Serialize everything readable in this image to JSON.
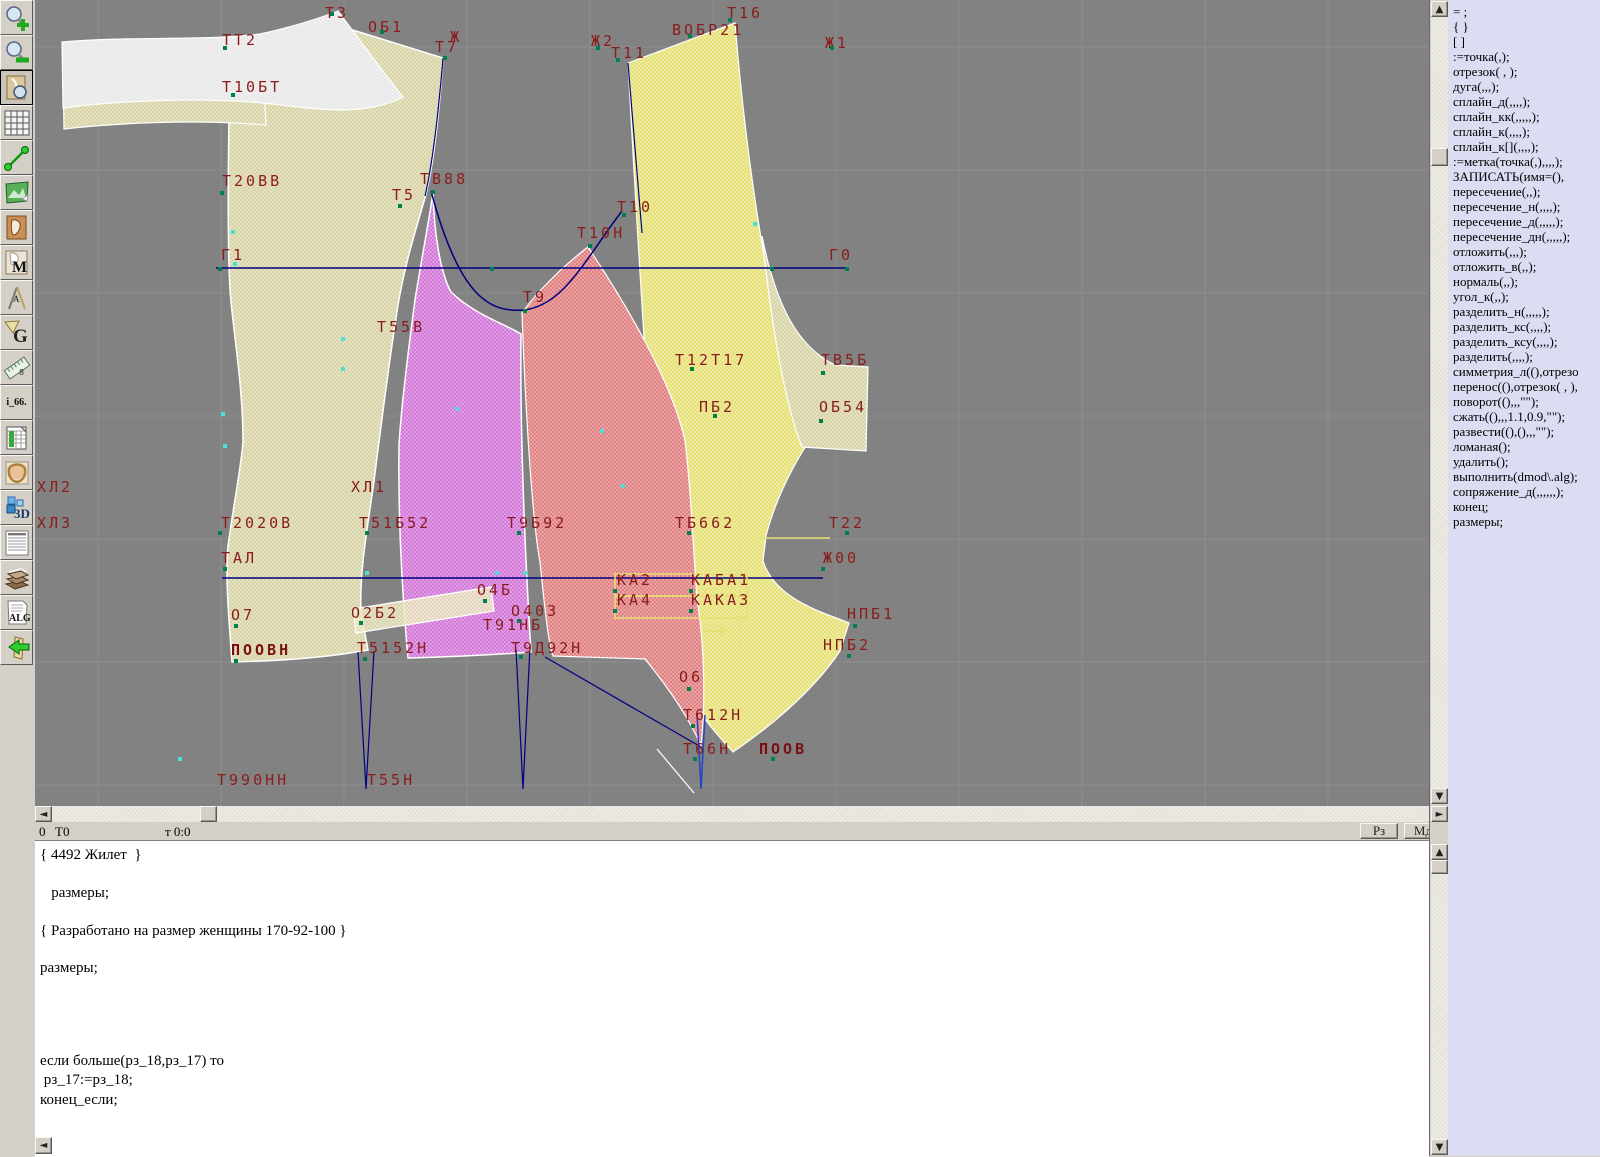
{
  "colors": {
    "canvas_bg": "#828282",
    "grid": "#8e8e8e",
    "beige": "#d6d2a2",
    "gray_piece": "#e7e7e7",
    "purple": "#d06ed6",
    "red": "#de7878",
    "yellow": "#e4e070",
    "navy": "#000080",
    "outline": "#ffffff",
    "label": "#8b1c1c",
    "panel_bg": "#dcdcf2",
    "chrome": "#d4d0c8"
  },
  "toolbar": {
    "icons": [
      {
        "name": "zoom-in-icon"
      },
      {
        "name": "zoom-out-icon"
      },
      {
        "name": "piece-zoom-icon",
        "active": true
      },
      {
        "name": "grid-icon"
      },
      {
        "name": "segment-icon"
      },
      {
        "name": "image-icon"
      },
      {
        "name": "pattern-card-icon"
      },
      {
        "name": "pattern-m-icon",
        "label": "M"
      },
      {
        "name": "measure-icon",
        "label": "А"
      },
      {
        "name": "g-icon",
        "label": "G"
      },
      {
        "name": "ruler-icon",
        "label": "8"
      },
      {
        "name": "i66-icon",
        "label": "i_66."
      },
      {
        "name": "table-icon"
      },
      {
        "name": "model-photo-icon"
      },
      {
        "name": "threed-icon",
        "label": "3D"
      },
      {
        "name": "list-icon"
      },
      {
        "name": "books-icon"
      },
      {
        "name": "alg-icon",
        "label": "ALG"
      },
      {
        "name": "exit-icon"
      }
    ]
  },
  "canvas": {
    "labels": [
      [
        "Т3",
        290,
        6
      ],
      [
        "ОБ1",
        333,
        20
      ],
      [
        "ТТ2",
        187,
        33
      ],
      [
        "Ж",
        415,
        30
      ],
      [
        "Т7",
        400,
        40
      ],
      [
        "Ж2",
        556,
        34
      ],
      [
        "Т11",
        576,
        46
      ],
      [
        "ВОБР21",
        637,
        23
      ],
      [
        "Т16",
        692,
        6
      ],
      [
        "Ж1",
        790,
        36
      ],
      [
        "Т10БТ",
        187,
        80
      ],
      [
        "Т20ВВ",
        187,
        174
      ],
      [
        "Т5",
        357,
        188
      ],
      [
        "ТВ88",
        385,
        172
      ],
      [
        "Т10",
        582,
        200
      ],
      [
        "Т10Н",
        542,
        226
      ],
      [
        "Г1",
        186,
        248
      ],
      [
        "Г0",
        794,
        248
      ],
      [
        "Т9",
        488,
        290
      ],
      [
        "Т55В",
        342,
        320
      ],
      [
        "Т12Т17",
        640,
        353
      ],
      [
        "ТВ5Б",
        786,
        353
      ],
      [
        "ПБ2",
        664,
        400
      ],
      [
        "ОБ54",
        784,
        400
      ],
      [
        "ХЛ2",
        2,
        480
      ],
      [
        "ХЛ1",
        316,
        480
      ],
      [
        "ХЛ3",
        2,
        516
      ],
      [
        "Т2020В",
        186,
        516
      ],
      [
        "Т51Б52",
        324,
        516
      ],
      [
        "Т9Б92",
        472,
        516
      ],
      [
        "ТБ662",
        640,
        516
      ],
      [
        "Т22",
        794,
        516
      ],
      [
        "ТАЛ",
        186,
        551
      ],
      [
        "Ж00",
        788,
        551
      ],
      [
        "КА2",
        582,
        573
      ],
      [
        "КАБА1",
        656,
        573
      ],
      [
        "КА4",
        582,
        593
      ],
      [
        "КАКА3",
        656,
        593
      ],
      [
        "О4Б",
        442,
        583
      ],
      [
        "О7",
        196,
        608
      ],
      [
        "О2Б2",
        316,
        606
      ],
      [
        "О403",
        476,
        604
      ],
      [
        "Т91НБ",
        448,
        618
      ],
      [
        "НПБ1",
        812,
        607
      ],
      [
        "ПООВН",
        196,
        643,
        1
      ],
      [
        "Т5152Н",
        322,
        641
      ],
      [
        "Т9Д92Н",
        476,
        641
      ],
      [
        "НПБ2",
        788,
        638
      ],
      [
        "О6",
        644,
        670
      ],
      [
        "Т612Н",
        648,
        708
      ],
      [
        "Т66Н",
        648,
        742
      ],
      [
        "ПООВ",
        724,
        742,
        1
      ],
      [
        "Т990НН",
        182,
        773
      ],
      [
        "Т55Н",
        332,
        773
      ]
    ],
    "points": {
      "green": [
        [
          295,
          12
        ],
        [
          345,
          30
        ],
        [
          188,
          46
        ],
        [
          408,
          56
        ],
        [
          561,
          46
        ],
        [
          581,
          58
        ],
        [
          653,
          34
        ],
        [
          693,
          18
        ],
        [
          795,
          46
        ],
        [
          196,
          93
        ],
        [
          185,
          191
        ],
        [
          363,
          204
        ],
        [
          396,
          190
        ],
        [
          587,
          213
        ],
        [
          553,
          244
        ],
        [
          183,
          267
        ],
        [
          455,
          267
        ],
        [
          735,
          267
        ],
        [
          810,
          267
        ],
        [
          488,
          309
        ],
        [
          655,
          367
        ],
        [
          786,
          371
        ],
        [
          678,
          414
        ],
        [
          784,
          419
        ],
        [
          183,
          531
        ],
        [
          330,
          531
        ],
        [
          482,
          531
        ],
        [
          652,
          531
        ],
        [
          810,
          531
        ],
        [
          188,
          567
        ],
        [
          786,
          567
        ],
        [
          578,
          589
        ],
        [
          578,
          609
        ],
        [
          654,
          589
        ],
        [
          654,
          609
        ],
        [
          448,
          599
        ],
        [
          199,
          624
        ],
        [
          324,
          621
        ],
        [
          482,
          619
        ],
        [
          818,
          624
        ],
        [
          199,
          659
        ],
        [
          328,
          657
        ],
        [
          484,
          655
        ],
        [
          812,
          654
        ],
        [
          652,
          687
        ],
        [
          656,
          724
        ],
        [
          658,
          757
        ],
        [
          736,
          757
        ]
      ],
      "cyan": [
        [
          196,
          230
        ],
        [
          198,
          262
        ],
        [
          306,
          337
        ],
        [
          306,
          367
        ],
        [
          186,
          412
        ],
        [
          188,
          444
        ],
        [
          420,
          407
        ],
        [
          565,
          429
        ],
        [
          586,
          484
        ],
        [
          143,
          757
        ],
        [
          330,
          571
        ],
        [
          460,
          571
        ],
        [
          488,
          571
        ],
        [
          718,
          222
        ]
      ]
    }
  },
  "hscrollbar": {
    "left_arrow": "◄",
    "right_arrow": "►"
  },
  "vscrollbar": {
    "up_arrow": "▲",
    "down_arrow": "▼"
  },
  "statusbar": {
    "left_value": "0",
    "point_name": "Т0",
    "cursor_pos": "т 0:0",
    "buttons": [
      {
        "label": "Рз"
      },
      {
        "label": "Мд"
      }
    ]
  },
  "editor": {
    "lines": [
      {
        "t": "{ 4492 Жилет  }",
        "y": 6
      },
      {
        "t": "   размеры;",
        "y": 44
      },
      {
        "t": "{ Разработано на размер женщины 170-92-100 }",
        "y": 82
      },
      {
        "t": "размеры;",
        "y": 119
      },
      {
        "t": "если больше(рз_18,рз_17) то",
        "y": 212
      },
      {
        "t": " рз_17:=рз_18;",
        "y": 231
      },
      {
        "t": "конец_если;",
        "y": 251
      }
    ]
  },
  "panel": {
    "items": [
      "= ;",
      "{  }",
      "[  ]",
      ":=точка(,);",
      "отрезок( , );",
      "дуга(,,,);",
      "сплайн_д(,,,,);",
      "сплайн_кк(,,,,,);",
      "сплайн_к(,,,,);",
      "сплайн_к[](,,,,);",
      ":=метка(точка(,),,,,);",
      "ЗАПИСАТЬ(имя=(),",
      "пересечение(,,);",
      "пересечение_н(,,,,);",
      "пересечение_д(,,,,,);",
      "пересечение_дн(,,,,,);",
      "отложить(,,,);",
      "отложить_в(,,);",
      "нормаль(,,);",
      "угол_к(,,);",
      "разделить_н(,,,,,);",
      "разделить_кс(,,,,);",
      "разделить_ксу(,,,,);",
      "разделить(,,,,);",
      "симметрия_л((),отрезо",
      "перенос((),отрезок( , ),",
      "поворот((),,,\"\");",
      "сжать((),,,1.1,0.9,\"\");",
      "развести((),(),,,\"\");",
      "ломаная();",
      "удалить();",
      "выполнить(dmod\\.alg);",
      "сопряжение_д(,,,,,,);",
      "конец;",
      "размеры;"
    ]
  }
}
